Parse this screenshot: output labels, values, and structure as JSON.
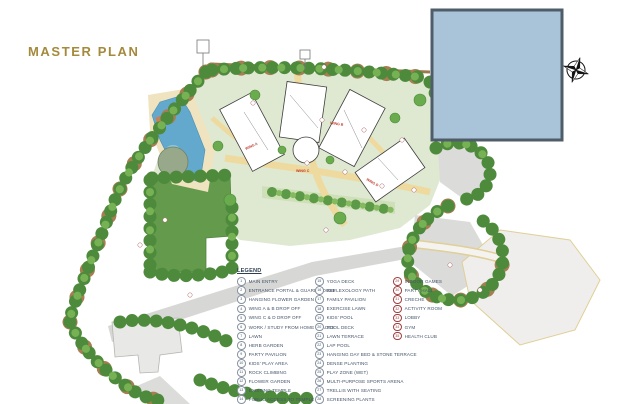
{
  "page": {
    "title": "MASTER PLAN"
  },
  "colors": {
    "title_gold": "#a5893c",
    "overlay_fill": "#a9c4d9",
    "overlay_border": "#4e5d69",
    "legend_text": "#44546a",
    "legend_circle": "#8792a0",
    "legend_circle_red": "#a03e3e",
    "tree_green": "#4e8a3c",
    "lawn_green": "#639a4c",
    "pool_blue": "#63a9cd",
    "path_cream": "#eeda9f"
  },
  "plan": {
    "wing_labels": [
      "WING A",
      "WING B",
      "WING C",
      "WING D"
    ],
    "compass": "compass-rose"
  },
  "legend": {
    "header": "LEGEND",
    "columns": [
      {
        "items": [
          {
            "num": "1",
            "label": "MAIN ENTRY"
          },
          {
            "num": "2",
            "label": "ENTRANCE PORTAL & GUARD HOUSE"
          },
          {
            "num": "3",
            "label": "HANGING FLOWER GARDEN"
          },
          {
            "num": "4",
            "label": "WING A & B DROP OFF"
          },
          {
            "num": "5",
            "label": "WING C & D DROP OFF"
          },
          {
            "num": "6",
            "label": "WORK / STUDY FROM HOME SPACES"
          },
          {
            "num": "7",
            "label": "LAWN"
          },
          {
            "num": "8",
            "label": "HERB GARDEN"
          },
          {
            "num": "9",
            "label": "PARTY PAVILION"
          },
          {
            "num": "10",
            "label": "KIDS' PLAY AREA"
          },
          {
            "num": "11",
            "label": "ROCK CLIMBING"
          },
          {
            "num": "12",
            "label": "FLOWER GARDEN"
          },
          {
            "num": "13",
            "label": "EXISTING TEMPLE"
          },
          {
            "num": "14",
            "label": "PUBLIC ACCESS TO TEMPLE"
          }
        ]
      },
      {
        "items": [
          {
            "num": "15",
            "label": "YOGA DECK"
          },
          {
            "num": "16",
            "label": "REFLEXOLOGY PATH"
          },
          {
            "num": "17",
            "label": "FAMILY PAVILION"
          },
          {
            "num": "18",
            "label": "EXERCISE LAWN"
          },
          {
            "num": "19",
            "label": "KIDS' POOL"
          },
          {
            "num": "20",
            "label": "POOL DECK"
          },
          {
            "num": "21",
            "label": "LAWN TERRACE"
          },
          {
            "num": "22",
            "label": "LAP POOL"
          },
          {
            "num": "23",
            "label": "HANGING DAY BED & STONE TERRACE"
          },
          {
            "num": "24",
            "label": "DENSE PLANTING"
          },
          {
            "num": "25",
            "label": "PLAY ZONE (WET)"
          },
          {
            "num": "26",
            "label": "MULTI-PURPOSE SPORTS ARENA"
          },
          {
            "num": "27",
            "label": "TRELLIS WITH SEATING"
          },
          {
            "num": "28",
            "label": "SCREENING PLANTS"
          }
        ]
      },
      {
        "accent": "red",
        "items": [
          {
            "num": "29",
            "label": "INDOOR GAMES"
          },
          {
            "num": "30",
            "label": "PARTY HALL"
          },
          {
            "num": "31",
            "label": "CRECHE"
          },
          {
            "num": "32",
            "label": "ACTIVITY ROOM"
          },
          {
            "num": "33",
            "label": "LOBBY"
          },
          {
            "num": "34",
            "label": "GYM"
          },
          {
            "num": "35",
            "label": "HEALTH CLUB"
          }
        ]
      }
    ]
  }
}
